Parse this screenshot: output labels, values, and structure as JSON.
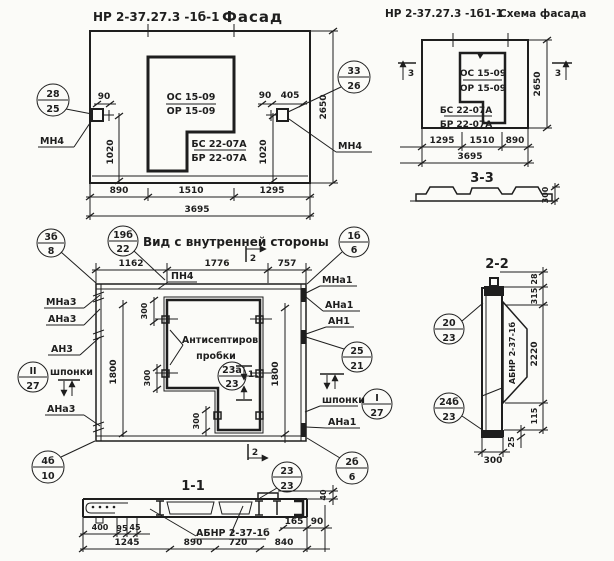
{
  "ink": "#1e1e1e",
  "titles": {
    "facade_prefix": "НР 2-37.27.3 -1б-1",
    "facade_name": "Фасад",
    "scheme_prefix": "НР 2-37.27.3 -1б1-1",
    "scheme_name": "Схема фасада",
    "view": "Вид с внутренней стороны",
    "sec11": "1-1",
    "sec22": "2-2",
    "sec33": "3-3"
  },
  "marks": {
    "os": "ОС 15-09",
    "or": "ОР 15-09",
    "bs": "БС 22-07А",
    "br": "БР 22-07А",
    "mn4": "МН4",
    "pn4": "ПН4",
    "abnr": "АБНР 2-37-1б",
    "mna3": "МНа3",
    "ana3": "АНа3",
    "an3": "АН3",
    "shponki": "шпонки",
    "mna1": "МНа1",
    "ana1": "АНа1",
    "an1": "АН1",
    "antiseptic1": "Антисептиров",
    "antiseptic2": "пробки"
  },
  "sections": {
    "s1": "1",
    "s2": "2",
    "s3": "3"
  },
  "callouts": {
    "c28_25": {
      "top": "28",
      "bot": "25"
    },
    "c33_26": {
      "top": "33",
      "bot": "26"
    },
    "c3b_8": {
      "top": "3б",
      "bot": "8"
    },
    "c19b_22": {
      "top": "19б",
      "bot": "22"
    },
    "c1b_6": {
      "top": "1б",
      "bot": "6"
    },
    "c25_21": {
      "top": "25",
      "bot": "21"
    },
    "cI_27": {
      "top": "I",
      "bot": "27"
    },
    "cII_27": {
      "top": "II",
      "bot": "27"
    },
    "c23a_23": {
      "top": "23а",
      "bot": "23"
    },
    "c2b_6": {
      "top": "2б",
      "bot": "6"
    },
    "c4b_10": {
      "top": "4б",
      "bot": "10"
    },
    "c23_23": {
      "top": "23",
      "bot": "23"
    },
    "c20_23": {
      "top": "20",
      "bot": "23"
    },
    "c24b_23": {
      "top": "24б",
      "bot": "23"
    }
  },
  "facade": {
    "d90l": "90",
    "d90r": "90",
    "d405": "405",
    "d1020l": "1020",
    "d1020r": "1020",
    "d2650": "2650",
    "d890": "890",
    "d1510": "1510",
    "d1295": "1295",
    "d3695": "3695"
  },
  "scheme": {
    "d2650": "2650",
    "d1295": "1295",
    "d1510": "1510",
    "d890": "890",
    "d3695": "3695",
    "d300": "300"
  },
  "view": {
    "d1162": "1162",
    "d1776": "1776",
    "d757": "757",
    "d1800l": "1800",
    "d1800r": "1800",
    "d300a": "300",
    "d300b": "300",
    "d300c": "300"
  },
  "s11": {
    "d400": "400",
    "d95": "95",
    "d45": "45",
    "d1245": "1245",
    "d890": "890",
    "d720": "720",
    "d840": "840",
    "d165": "165",
    "d90": "90",
    "d40": "40"
  },
  "s22": {
    "d28": "28",
    "d315": "315",
    "d2220": "2220",
    "d115": "115",
    "d25": "25",
    "d300": "300"
  }
}
